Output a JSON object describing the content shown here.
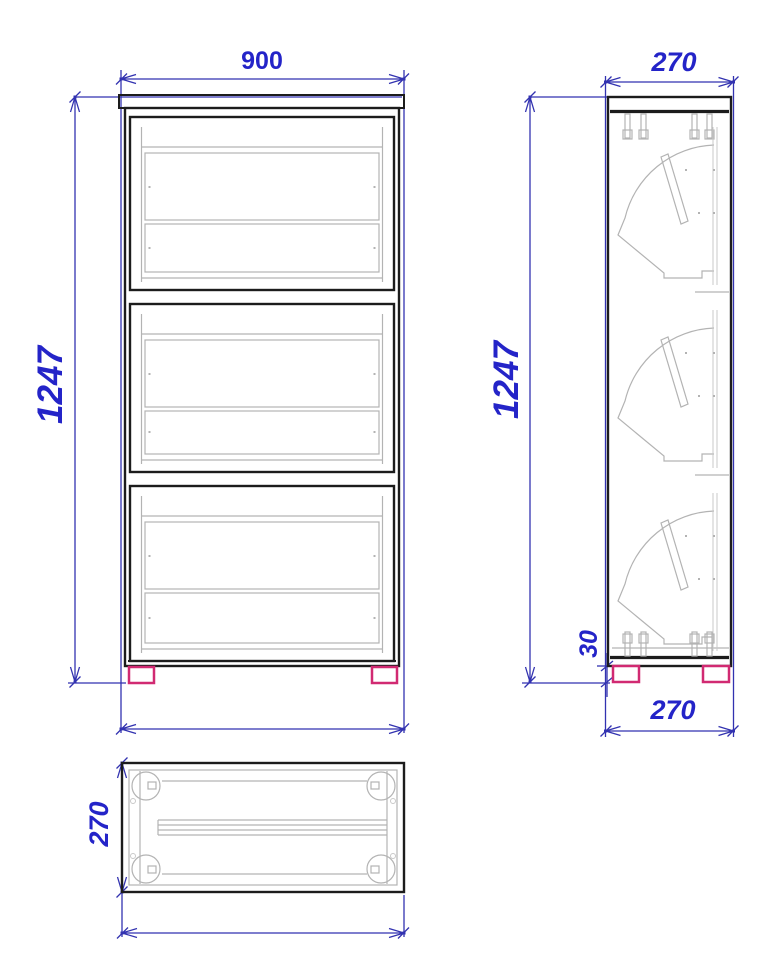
{
  "drawing_type": "furniture-three-view-technical-drawing",
  "colors": {
    "background": "#ffffff",
    "outline": "#1c1c1c",
    "detail": "#b3b3b3",
    "detail_soft": "#c9c9c9",
    "dimension": "#3232b0",
    "label": "#2424c8",
    "feet": "#d12a72"
  },
  "views": {
    "front": {
      "width_label": "900",
      "height_label": "1247"
    },
    "side": {
      "depth_top_label": "270",
      "height_label": "1247",
      "feet_height_label": "30",
      "depth_bottom_label": "270"
    },
    "plan": {
      "depth_label": "270"
    }
  }
}
